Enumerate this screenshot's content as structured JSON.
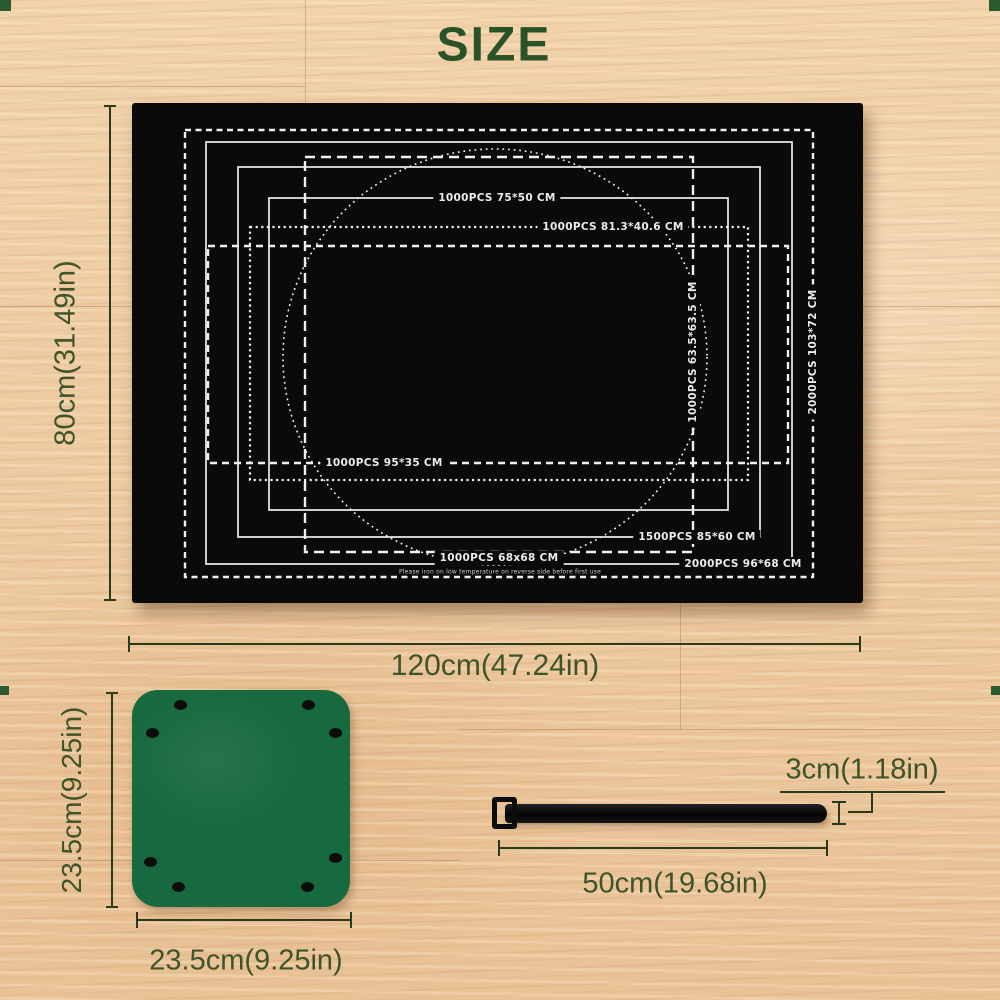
{
  "title": "SIZE",
  "colors": {
    "title_green": "#2b5227",
    "dimension_green": "#40542a",
    "mat_black": "#0a0a0a",
    "pad_green": "#17693f",
    "print_white": "#efefef",
    "strap_black": "#0c0c0c",
    "wood_base": "#ecc79e"
  },
  "mat": {
    "width_label": "120cm(47.24in)",
    "height_label": "80cm(31.49in)",
    "care_note": "Please iron on low temperature on reverse side before first use",
    "sizes": [
      {
        "label": "2000PCS  103*72 CM",
        "pcs": "2000PCS",
        "size_cm": "103*72",
        "x": 53,
        "y": 27,
        "w": 628,
        "h": 447,
        "stroke": "st-dash-a",
        "vertical": true,
        "lx": 681,
        "ly": 249
      },
      {
        "label": "2000PCS  96*68 CM",
        "pcs": "2000PCS",
        "size_cm": "96*68",
        "x": 74,
        "y": 39,
        "w": 586,
        "h": 422,
        "stroke": "st-solid",
        "vertical": false,
        "lx": 611,
        "ly": 461
      },
      {
        "label": "1000PCS  63.5*63.5 CM",
        "pcs": "1000PCS",
        "size_cm": "63.5*63.5",
        "x": 173,
        "y": 54,
        "w": 388,
        "h": 395,
        "stroke": "st-dash-c",
        "vertical": true,
        "lx": 561,
        "ly": 249
      },
      {
        "label": "1500PCS  85*60 CM",
        "pcs": "1500PCS",
        "size_cm": "85*60",
        "x": 106,
        "y": 64,
        "w": 522,
        "h": 370,
        "stroke": "st-solid",
        "vertical": false,
        "lx": 565,
        "ly": 434
      },
      {
        "label": "1000PCS  75*50 CM",
        "pcs": "1000PCS",
        "size_cm": "75*50",
        "x": 137,
        "y": 95,
        "w": 459,
        "h": 312,
        "stroke": "st-solid",
        "vertical": false,
        "lx": 365,
        "ly": 95
      },
      {
        "label": "1000PCS  81.3*40.6 CM",
        "pcs": "1000PCS",
        "size_cm": "81.3*40.6",
        "x": 118,
        "y": 124,
        "w": 498,
        "h": 253,
        "stroke": "st-dot",
        "vertical": false,
        "lx": 481,
        "ly": 124
      },
      {
        "label": "1000PCS  95*35 CM",
        "pcs": "1000PCS",
        "size_cm": "95*35",
        "x": 76,
        "y": 143,
        "w": 580,
        "h": 217,
        "stroke": "st-dash-g",
        "vertical": false,
        "lx": 252,
        "ly": 360
      }
    ],
    "circle": {
      "label": "1000PCS 68x68 CM",
      "pcs": "1000PCS",
      "size_cm": "68x68",
      "cx": 363,
      "cy": 254,
      "rx": 212,
      "ry": 208,
      "lx": 367,
      "ly": 455
    }
  },
  "pad": {
    "width_label": "23.5cm(9.25in)",
    "height_label": "23.5cm(9.25in)",
    "holes": [
      [
        48,
        15
      ],
      [
        20,
        43
      ],
      [
        176,
        15
      ],
      [
        203,
        43
      ],
      [
        18,
        172
      ],
      [
        46,
        197
      ],
      [
        203,
        168
      ],
      [
        175,
        197
      ]
    ]
  },
  "strap": {
    "length_label": "50cm(19.68in)",
    "width_label": "3cm(1.18in)"
  }
}
